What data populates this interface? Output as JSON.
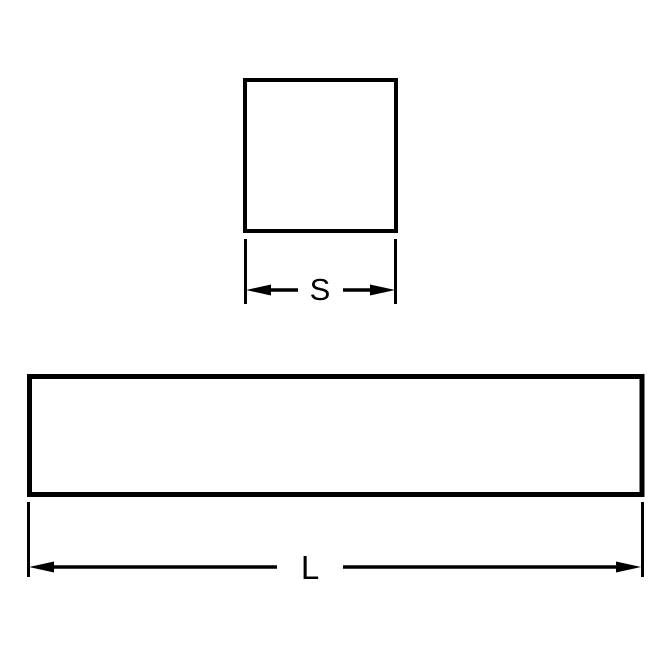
{
  "page": {
    "background_color": "#ffffff"
  },
  "drawing": {
    "line_color": "#000000",
    "views": {
      "square_cross_section": {
        "dimension_label": "S"
      },
      "bar_length_view": {
        "dimension_label": "L"
      }
    }
  }
}
